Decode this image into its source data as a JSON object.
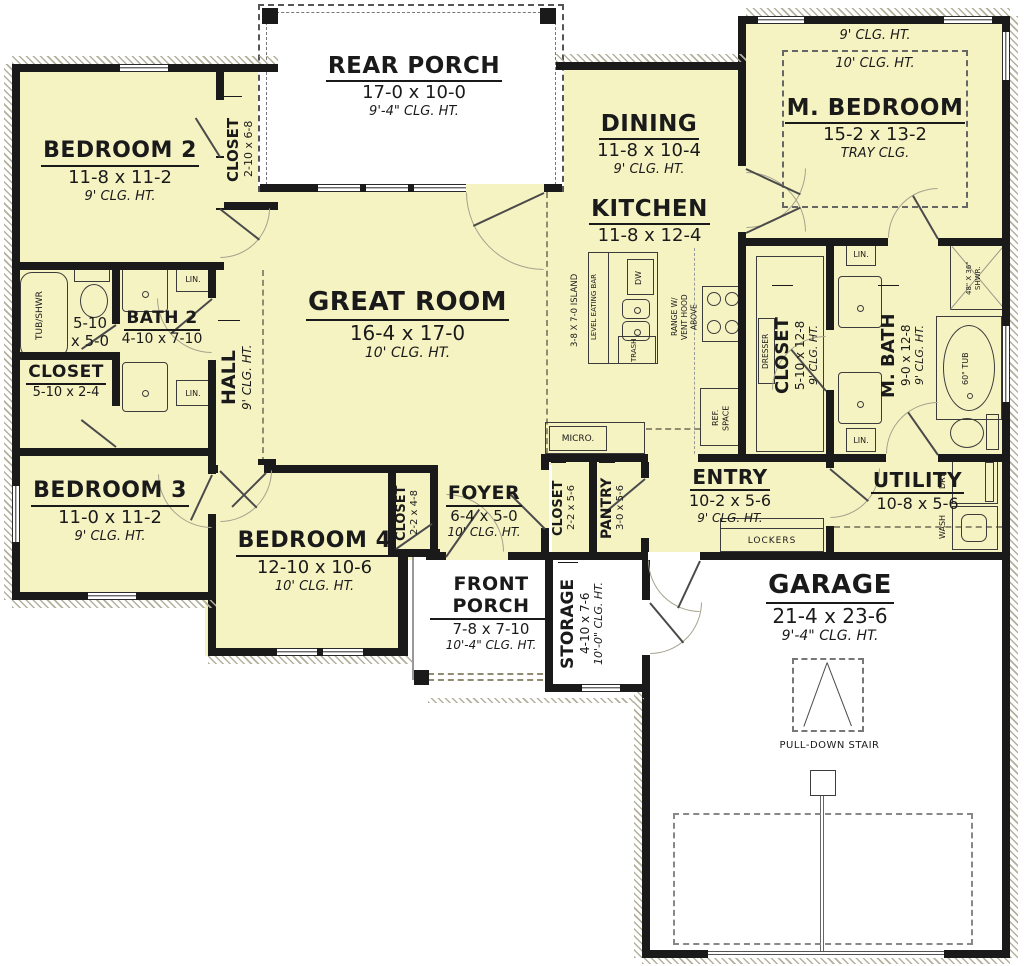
{
  "colors": {
    "floor_fill": "#f6f3c3",
    "wall": "#1a1a1a",
    "porch_fill": "#ffffff"
  },
  "rooms": {
    "bedroom2": {
      "name": "BEDROOM 2",
      "dim": "11-8 x 11-2",
      "clg": "9' CLG. HT."
    },
    "bedroom2_closet": {
      "name": "CLOSET",
      "dim": "2-10 x 6-8"
    },
    "rear_porch": {
      "name": "REAR PORCH",
      "dim": "17-0 x 10-0",
      "clg": "9'-4\" CLG. HT."
    },
    "dining": {
      "name": "DINING",
      "dim": "11-8 x 10-4",
      "clg": "9' CLG. HT."
    },
    "kitchen": {
      "name": "KITCHEN",
      "dim": "11-8 x 12-4"
    },
    "m_bedroom": {
      "name": "M. BEDROOM",
      "dim": "15-2 x 13-2",
      "clg_outer": "9' CLG. HT.",
      "clg_inner": "10' CLG. HT.",
      "tray": "TRAY CLG."
    },
    "great_room": {
      "name": "GREAT ROOM",
      "dim": "16-4 x 17-0",
      "clg": "10' CLG. HT."
    },
    "hall": {
      "name": "HALL",
      "clg": "9' CLG. HT."
    },
    "bath2_wc": {
      "dim_line1": "5-10",
      "dim_line2": "x 5-0"
    },
    "bath2": {
      "name": "BATH 2",
      "dim": "4-10 x 7-10"
    },
    "hall_closet": {
      "name": "CLOSET",
      "dim": "5-10 x 2-4"
    },
    "bedroom3": {
      "name": "BEDROOM 3",
      "dim": "11-0 x 11-2",
      "clg": "9' CLG. HT."
    },
    "bedroom4": {
      "name": "BEDROOM 4",
      "dim": "12-10 x 10-6",
      "clg": "10' CLG. HT."
    },
    "bedroom4_closet": {
      "name": "CLOSET",
      "dim": "2-2 x 4-8"
    },
    "foyer": {
      "name": "FOYER",
      "dim": "6-4 x 5-0",
      "clg": "10' CLG. HT."
    },
    "foyer_closet": {
      "name": "CLOSET",
      "dim": "2-2 x 5-6"
    },
    "pantry": {
      "name": "PANTRY",
      "dim": "3-0 x 5-6"
    },
    "entry": {
      "name": "ENTRY",
      "dim": "10-2 x 5-6",
      "clg": "9' CLG. HT."
    },
    "utility": {
      "name": "UTILITY",
      "dim": "10-8 x 5-6"
    },
    "m_closet": {
      "name": "CLOSET",
      "dim": "5-10 x 12-8",
      "clg": "9' CLG. HT."
    },
    "m_bath": {
      "name": "M. BATH",
      "dim": "9-0 x 12-8",
      "clg": "9' CLG. HT."
    },
    "front_porch": {
      "name": "FRONT PORCH",
      "dim": "7-8 x 7-10",
      "clg": "10'-4\" CLG. HT."
    },
    "storage": {
      "name": "STORAGE",
      "dim": "4-10 x 7-6",
      "clg": "10'-0\" CLG. HT."
    },
    "garage": {
      "name": "GARAGE",
      "dim": "21-4 x 23-6",
      "clg": "9'-4\" CLG. HT."
    }
  },
  "fixtures": {
    "tub_shwr": "TUB/SHWR",
    "lin": "LIN.",
    "island": "3-8 X 7-0 ISLAND",
    "eating_bar": "LEVEL EATING BAR",
    "dw": "DW",
    "trash": "TRASH",
    "range_l1": "RANGE W/",
    "range_l2": "VENT HOOD",
    "range_l3": "ABOVE",
    "ref_l1": "REF.",
    "ref_l2": "SPACE",
    "micro": "MICRO.",
    "dresser": "DRESSER",
    "shower_l1": "48\" X 36\"",
    "shower_l2": "SHWR.",
    "tub": "60\" TUB",
    "lockers": "LOCKERS",
    "wash": "WASH",
    "dry": "DRY",
    "pull_down": "PULL-DOWN STAIR"
  }
}
